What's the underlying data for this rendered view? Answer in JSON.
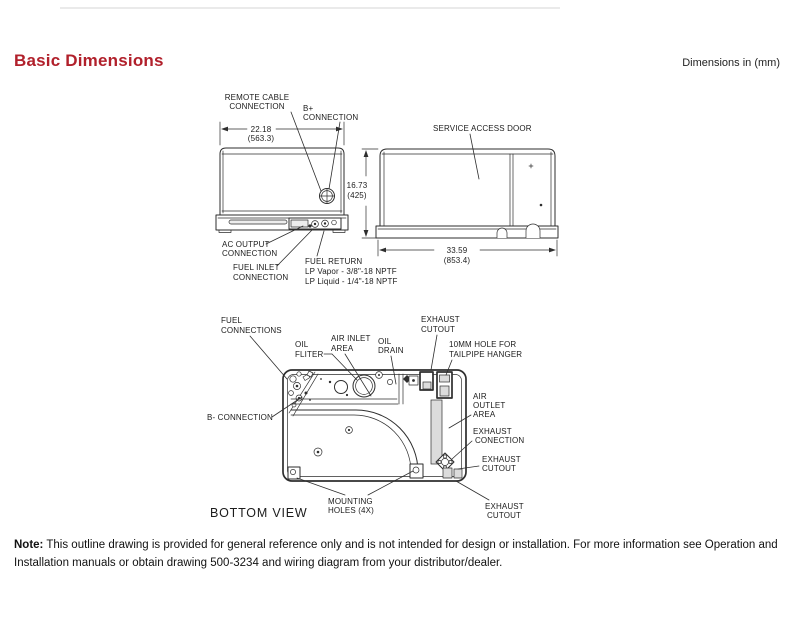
{
  "page": {
    "title": "Basic Dimensions",
    "units": "Dimensions in (mm)",
    "note_label": "Note:",
    "note_text": "This outline drawing is provided for general reference only and is not intended for design or installation. For more information see Operation and Installation manuals or obtain drawing 500-3234 and wiring diagram from your distributor/dealer.",
    "accent_color": "#b1202b",
    "line_color": "#2e2e2e"
  },
  "front_view": {
    "dims": {
      "width_in": "22.18",
      "width_mm": "(563.3)"
    },
    "labels": {
      "remote_cable_1": "REMOTE CABLE",
      "remote_cable_2": "CONNECTION",
      "b_plus_1": "B+",
      "b_plus_2": "CONNECTION",
      "ac_output_1": "AC OUTPUT",
      "ac_output_2": "CONNECTION",
      "fuel_inlet_1": "FUEL INLET",
      "fuel_inlet_2": "CONNECTION",
      "fuel_return_1": "FUEL RETURN",
      "fuel_return_2": "LP Vapor - 3/8\"-18 NPTF",
      "fuel_return_3": "LP Liquid - 1/4\"-18 NPTF"
    }
  },
  "side_view": {
    "dims": {
      "height_in": "16.73",
      "height_mm": "(425)",
      "length_in": "33.59",
      "length_mm": "(853.4)"
    },
    "labels": {
      "service_access_door": "SERVICE ACCESS DOOR"
    }
  },
  "bottom_view": {
    "caption": "BOTTOM VIEW",
    "labels": {
      "fuel_connections_1": "FUEL",
      "fuel_connections_2": "CONNECTIONS",
      "oil_filter_1": "OIL",
      "oil_filter_2": "FLITER",
      "air_inlet_1": "AIR INLET",
      "air_inlet_2": "AREA",
      "oil_drain_1": "OIL",
      "oil_drain_2": "DRAIN",
      "exhaust_cutout_top_1": "EXHAUST",
      "exhaust_cutout_top_2": "CUTOUT",
      "hanger_hole_1": "10MM HOLE FOR",
      "hanger_hole_2": "TAILPIPE HANGER",
      "air_outlet_1": "AIR",
      "air_outlet_2": "OUTLET",
      "air_outlet_3": "AREA",
      "exhaust_connection_1": "EXHAUST",
      "exhaust_connection_2": "CONECTION",
      "exhaust_cutout_right_1": "EXHAUST",
      "exhaust_cutout_right_2": "CUTOUT",
      "b_minus": "B- CONNECTION",
      "mounting_holes_1": "MOUNTING",
      "mounting_holes_2": "HOLES (4X)",
      "exhaust_cutout_bottom_1": "EXHAUST",
      "exhaust_cutout_bottom_2": "CUTOUT"
    }
  }
}
